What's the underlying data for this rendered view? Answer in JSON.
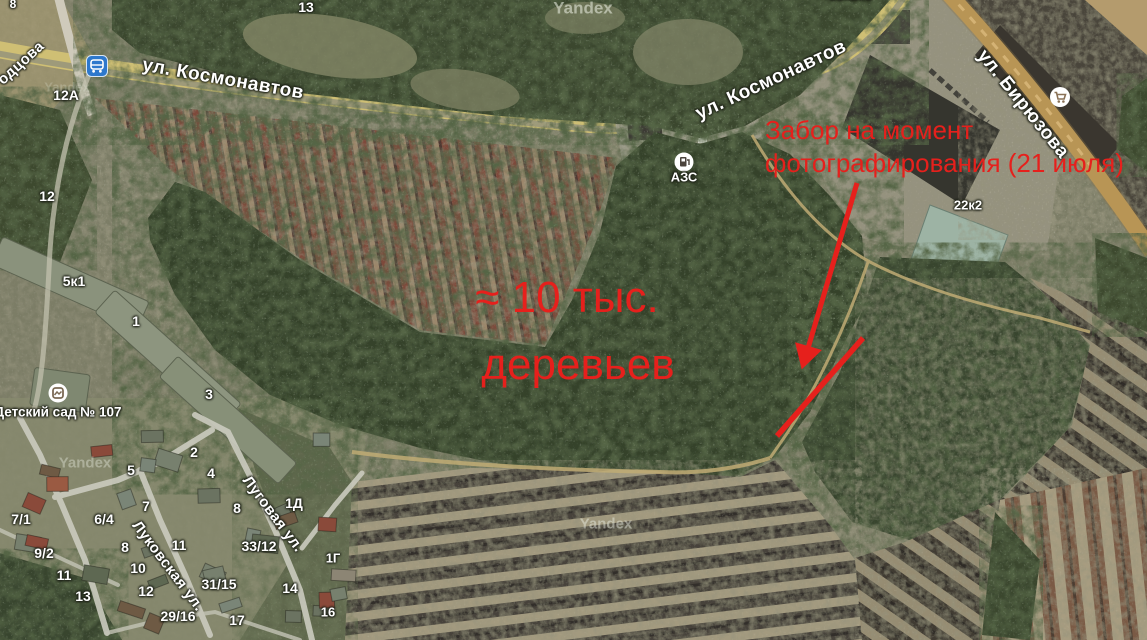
{
  "map": {
    "provider_watermark": "Yandex",
    "watermarks": [
      {
        "text": "Yandex",
        "x": 583,
        "y": 8,
        "size": 17,
        "opacity": 0.55
      },
      {
        "text": "Yandex",
        "x": 67,
        "y": 87,
        "size": 13,
        "opacity": 0.22
      },
      {
        "text": "Yandex",
        "x": 85,
        "y": 463,
        "size": 15,
        "opacity": 0.38
      },
      {
        "text": "Yandex",
        "x": 606,
        "y": 524,
        "size": 15,
        "opacity": 0.45
      }
    ],
    "streets": [
      {
        "text": "одцова",
        "x": 21,
        "y": 63,
        "rot": -42,
        "size": 15
      },
      {
        "text": "ул. Космонавтов",
        "x": 223,
        "y": 79,
        "rot": 10,
        "size": 19
      },
      {
        "text": "ул. Космонавтов",
        "x": 771,
        "y": 80,
        "rot": -25,
        "size": 19
      },
      {
        "text": "ул. Бирюзова",
        "x": 1023,
        "y": 104,
        "rot": 51,
        "size": 19
      },
      {
        "text": "Луговая ул.",
        "x": 273,
        "y": 514,
        "rot": 53,
        "size": 15
      },
      {
        "text": "Луковская ул.",
        "x": 168,
        "y": 566,
        "rot": 53,
        "size": 15
      }
    ],
    "house_numbers": [
      {
        "text": "8",
        "x": 13,
        "y": 4,
        "size": 12
      },
      {
        "text": "13",
        "x": 306,
        "y": 7,
        "size": 14
      },
      {
        "text": "12А",
        "x": 66,
        "y": 95,
        "size": 14
      },
      {
        "text": "12",
        "x": 47,
        "y": 196,
        "size": 14
      },
      {
        "text": "5к1",
        "x": 74,
        "y": 281,
        "size": 14
      },
      {
        "text": "1",
        "x": 136,
        "y": 321,
        "size": 14
      },
      {
        "text": "3",
        "x": 209,
        "y": 394,
        "size": 14
      },
      {
        "text": "22к2",
        "x": 968,
        "y": 205,
        "size": 13
      },
      {
        "text": "22к202",
        "x": 851,
        "y": -5,
        "size": 13
      },
      {
        "text": "2",
        "x": 194,
        "y": 452,
        "size": 14
      },
      {
        "text": "5",
        "x": 131,
        "y": 470,
        "size": 14
      },
      {
        "text": "4",
        "x": 211,
        "y": 473,
        "size": 14
      },
      {
        "text": "7",
        "x": 146,
        "y": 506,
        "size": 14
      },
      {
        "text": "7/1",
        "x": 21,
        "y": 519,
        "size": 14
      },
      {
        "text": "6/4",
        "x": 104,
        "y": 519,
        "size": 14
      },
      {
        "text": "8",
        "x": 237,
        "y": 508,
        "size": 14
      },
      {
        "text": "1Д",
        "x": 294,
        "y": 503,
        "size": 14
      },
      {
        "text": "9/2",
        "x": 44,
        "y": 553,
        "size": 14
      },
      {
        "text": "8",
        "x": 125,
        "y": 547,
        "size": 14
      },
      {
        "text": "11",
        "x": 179,
        "y": 545,
        "size": 14
      },
      {
        "text": "33/12",
        "x": 259,
        "y": 546,
        "size": 14
      },
      {
        "text": "11",
        "x": 64,
        "y": 575,
        "size": 14
      },
      {
        "text": "10",
        "x": 138,
        "y": 568,
        "size": 14
      },
      {
        "text": "13",
        "x": 83,
        "y": 596,
        "size": 14
      },
      {
        "text": "12",
        "x": 146,
        "y": 591,
        "size": 14
      },
      {
        "text": "31/15",
        "x": 219,
        "y": 584,
        "size": 14
      },
      {
        "text": "29/16",
        "x": 178,
        "y": 616,
        "size": 14
      },
      {
        "text": "17",
        "x": 237,
        "y": 620,
        "size": 14
      },
      {
        "text": "14",
        "x": 290,
        "y": 588,
        "size": 14
      },
      {
        "text": "16",
        "x": 328,
        "y": 612,
        "size": 13
      },
      {
        "text": "1Г",
        "x": 333,
        "y": 558,
        "size": 13
      }
    ],
    "pois": {
      "bus_stop": {
        "x": 97,
        "y": 66
      },
      "gas_station": {
        "label": "АЗС",
        "x": 684,
        "y": 162,
        "label_y": 177
      },
      "kindergarten": {
        "label": "Детский сад № 107",
        "x": 58,
        "y": 393,
        "label_y": 412
      },
      "shop": {
        "x": 1060,
        "y": 97
      }
    }
  },
  "annotation": {
    "color": "#e6201c",
    "trees_line1": "≈ 10 тыс.",
    "trees_line2": "деревьев",
    "trees_pos": {
      "x1": 567,
      "y1": 298,
      "x2": 578,
      "y2": 365,
      "size": 44
    },
    "fence_line1": "Забор на момент",
    "fence_line2": "фотографирования (21 июля)",
    "fence_pos": {
      "x": 765,
      "y1": 117,
      "y2": 150,
      "size": 26
    }
  }
}
